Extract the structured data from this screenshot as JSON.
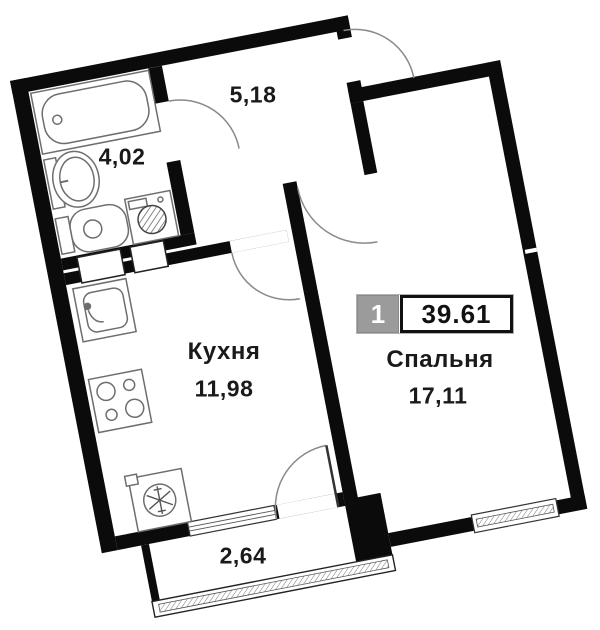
{
  "plan": {
    "type": "apartment-floor-plan",
    "badge": {
      "unit_number": "1",
      "total_area": "39.61"
    },
    "rooms": {
      "hallway": {
        "name": "",
        "area": "5,18"
      },
      "bathroom": {
        "name": "",
        "area": "4,02"
      },
      "kitchen": {
        "name": "Кухня",
        "area": "11,98"
      },
      "bedroom": {
        "name": "Спальня",
        "area": "17,11"
      },
      "balcony": {
        "name": "",
        "area": "2,64"
      }
    },
    "fixtures": [
      "bathtub",
      "wash-basin",
      "toilet",
      "washing-machine",
      "kitchen-sink",
      "hob",
      "fridge"
    ],
    "openings": [
      "entrance-door",
      "bathroom-door",
      "kitchen-door",
      "bedroom-door",
      "balcony-door"
    ],
    "windows": [
      "kitchen-window",
      "bedroom-window",
      "balcony-glazing"
    ],
    "colors": {
      "walls": "#0b0b0b",
      "background": "#ffffff",
      "badge_gray": "#9b9b9b",
      "fixture_line": "#6e6e6e",
      "arc_line": "#8a8a8a"
    },
    "rotation_degrees": -11
  }
}
